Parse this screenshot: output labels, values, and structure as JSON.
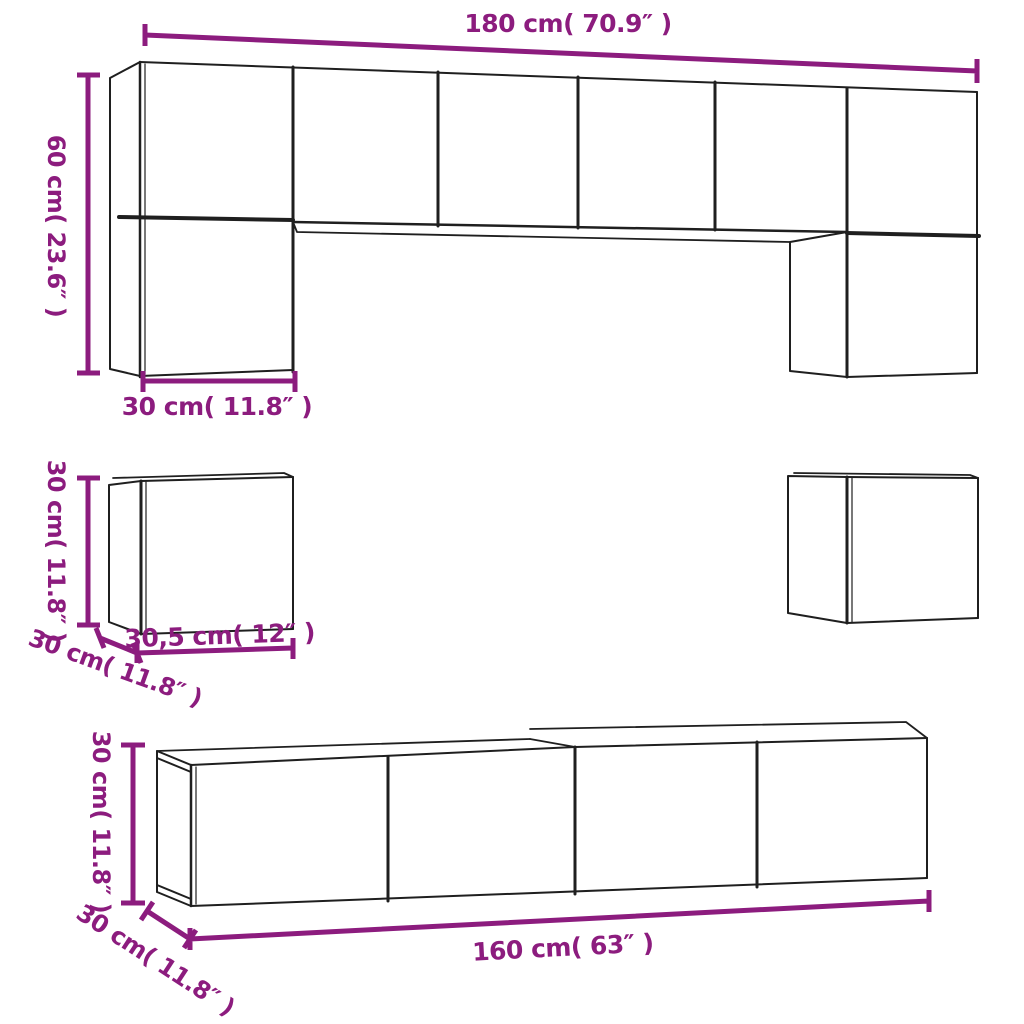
{
  "figure": {
    "title": "TV cabinet set dimension diagram",
    "type": "product-dimension-drawing"
  },
  "colors": {
    "dimension_accent": "#8c1c7e",
    "outline": "#1f1f1f",
    "background": "#ffffff"
  },
  "labels": {
    "wall_unit_width": "180 cm( 70.9″ )",
    "wall_unit_height": "60 cm( 23.6″ )",
    "wall_cabinet_width": "30 cm( 11.8″ )",
    "cube_height": "30 cm( 11.8″ )",
    "cube_depth": "30 cm( 11.8″ )",
    "cube_width": "30,5 cm( 12″ )",
    "tv_stand_height": "30 cm( 11.8″ )",
    "tv_stand_depth": "30 cm( 11.8″ )",
    "tv_stand_width": "160 cm( 63″ )"
  }
}
